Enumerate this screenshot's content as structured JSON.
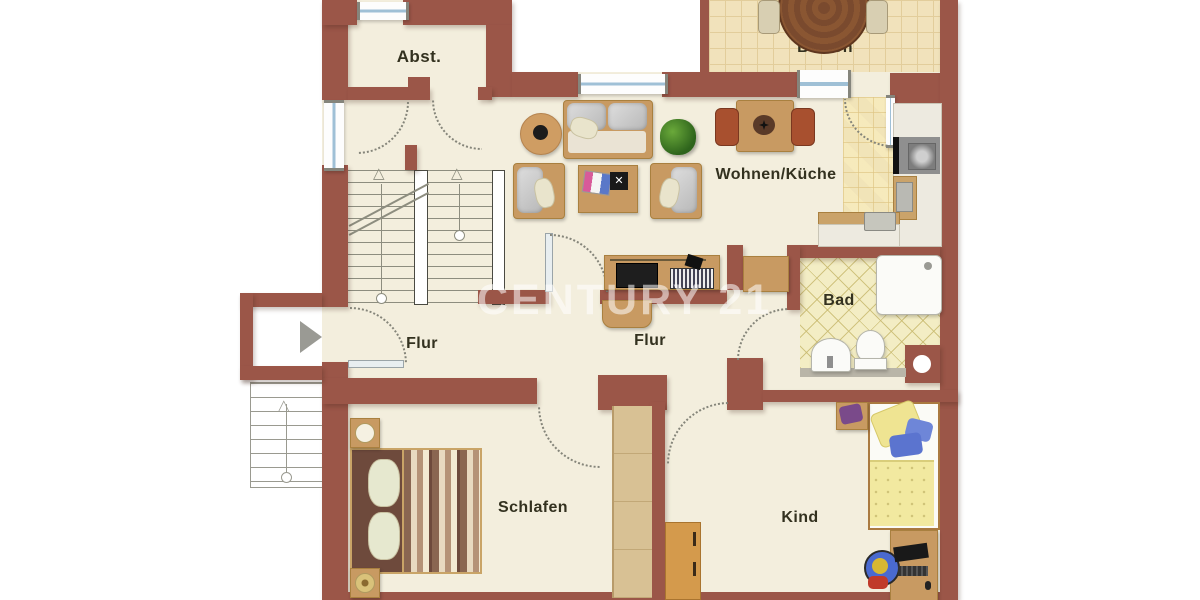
{
  "watermark": {
    "text": "CENTURY 21"
  },
  "rooms": [
    {
      "id": "abst",
      "label": "Abst."
    },
    {
      "id": "balkon",
      "label": "Balkon"
    },
    {
      "id": "wohnen",
      "label": "Wohnen/Küche"
    },
    {
      "id": "bad",
      "label": "Bad"
    },
    {
      "id": "flur_left",
      "label": "Flur"
    },
    {
      "id": "flur_mid",
      "label": "Flur"
    },
    {
      "id": "schlafen",
      "label": "Schlafen"
    },
    {
      "id": "kind",
      "label": "Kind"
    }
  ],
  "icons": {
    "entrance_arrow": "",
    "stair_arrow_up": "△"
  },
  "colors": {
    "wall": "#9b5648",
    "floor": "#f3eedd",
    "balcony_tile": "#f1e2bb",
    "kitchen_tile": "#f8eec8",
    "bad_tile": "#f3edc4",
    "wood": "#c89a62",
    "window_glass": "#9fc0d6",
    "stair_line": "#8d8d7f",
    "label": "#33311f",
    "outside": "#ffffff"
  }
}
